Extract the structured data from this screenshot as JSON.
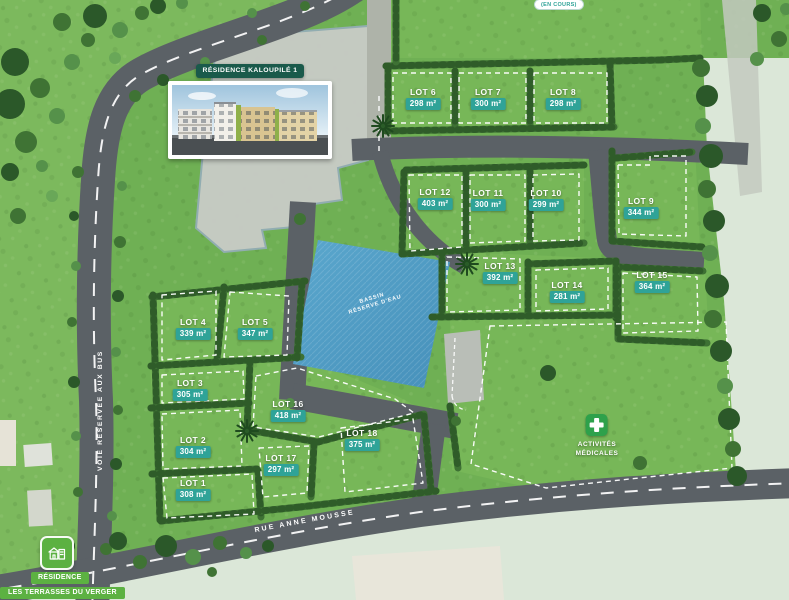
{
  "plan_title": "RÉSIDENCE KALOUPILÉ 1",
  "status_badge": "(EN COURS)",
  "labels": {
    "basin_line1": "BASSIN",
    "basin_line2": "RÉSERVE D'EAU",
    "bus_lane": "VOIE RÉSERVÉE AUX BUS",
    "street": "RUE ANNE MOUSSE",
    "medical_line1": "ACTIVITÉS",
    "medical_line2": "MÉDICALES",
    "residence_line1": "RÉSIDENCE",
    "residence_line2": "LES TERRASSES DU VERGER"
  },
  "lots": [
    {
      "name": "LOT 1",
      "area": "308 m²",
      "x": 193,
      "y": 478
    },
    {
      "name": "LOT 2",
      "area": "304 m²",
      "x": 193,
      "y": 435
    },
    {
      "name": "LOT 3",
      "area": "305 m²",
      "x": 190,
      "y": 378
    },
    {
      "name": "LOT 4",
      "area": "339 m²",
      "x": 193,
      "y": 317
    },
    {
      "name": "LOT 5",
      "area": "347 m²",
      "x": 255,
      "y": 317
    },
    {
      "name": "LOT 6",
      "area": "298 m²",
      "x": 423,
      "y": 87
    },
    {
      "name": "LOT 7",
      "area": "300 m²",
      "x": 488,
      "y": 87
    },
    {
      "name": "LOT 8",
      "area": "298 m²",
      "x": 563,
      "y": 87
    },
    {
      "name": "LOT 9",
      "area": "344 m²",
      "x": 641,
      "y": 196
    },
    {
      "name": "LOT 10",
      "area": "299 m²",
      "x": 546,
      "y": 188
    },
    {
      "name": "LOT 11",
      "area": "300 m²",
      "x": 488,
      "y": 188
    },
    {
      "name": "LOT 12",
      "area": "403 m²",
      "x": 435,
      "y": 187
    },
    {
      "name": "LOT 13",
      "area": "392 m²",
      "x": 500,
      "y": 261
    },
    {
      "name": "LOT 14",
      "area": "281 m²",
      "x": 567,
      "y": 280
    },
    {
      "name": "LOT 15",
      "area": "364 m²",
      "x": 652,
      "y": 270
    },
    {
      "name": "LOT 16",
      "area": "418 m²",
      "x": 288,
      "y": 399
    },
    {
      "name": "LOT 17",
      "area": "297 m²",
      "x": 281,
      "y": 453
    },
    {
      "name": "LOT 18",
      "area": "375 m²",
      "x": 362,
      "y": 428
    }
  ],
  "colors": {
    "grass": "#6fb054",
    "field": "#77b758",
    "hedge": "#3e7134",
    "road": "#5b6166",
    "road_light": "#aeb3a9",
    "pale_land": "#dbe7d8",
    "water": "#4f9ec6",
    "area_badge_teal": "#2fa398",
    "banner_dark_green": "#1a5a4b",
    "residence_bright_green": "#5cb142",
    "medical_green": "#2ea14b"
  }
}
